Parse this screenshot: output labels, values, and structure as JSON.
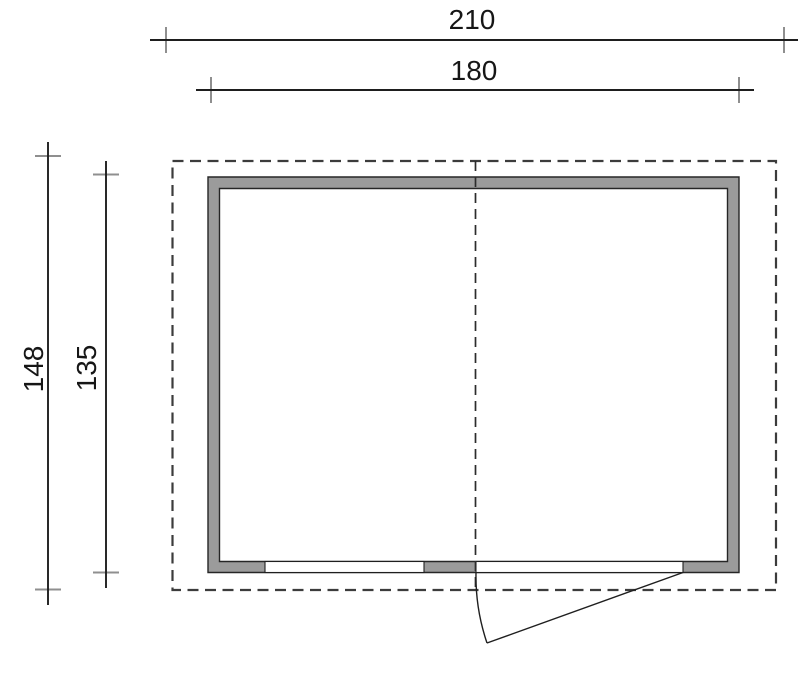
{
  "plan": {
    "title": "shed-floor-plan",
    "dimensions": {
      "overall_width": "210",
      "building_width": "180",
      "overall_depth": "148",
      "building_depth": "135"
    },
    "colors": {
      "wall_fill": "#9b9b9b",
      "dim_line": "#1e1e1e",
      "tick": "#8f8f8f",
      "dashed_outline": "#3c3c3c"
    },
    "features": {
      "roof_overhang": "dashed rectangle",
      "ridge_axis": "dashed center line",
      "openings": [
        "window-opening",
        "door-opening"
      ],
      "door_swing": "arc open ~20 degrees"
    }
  }
}
